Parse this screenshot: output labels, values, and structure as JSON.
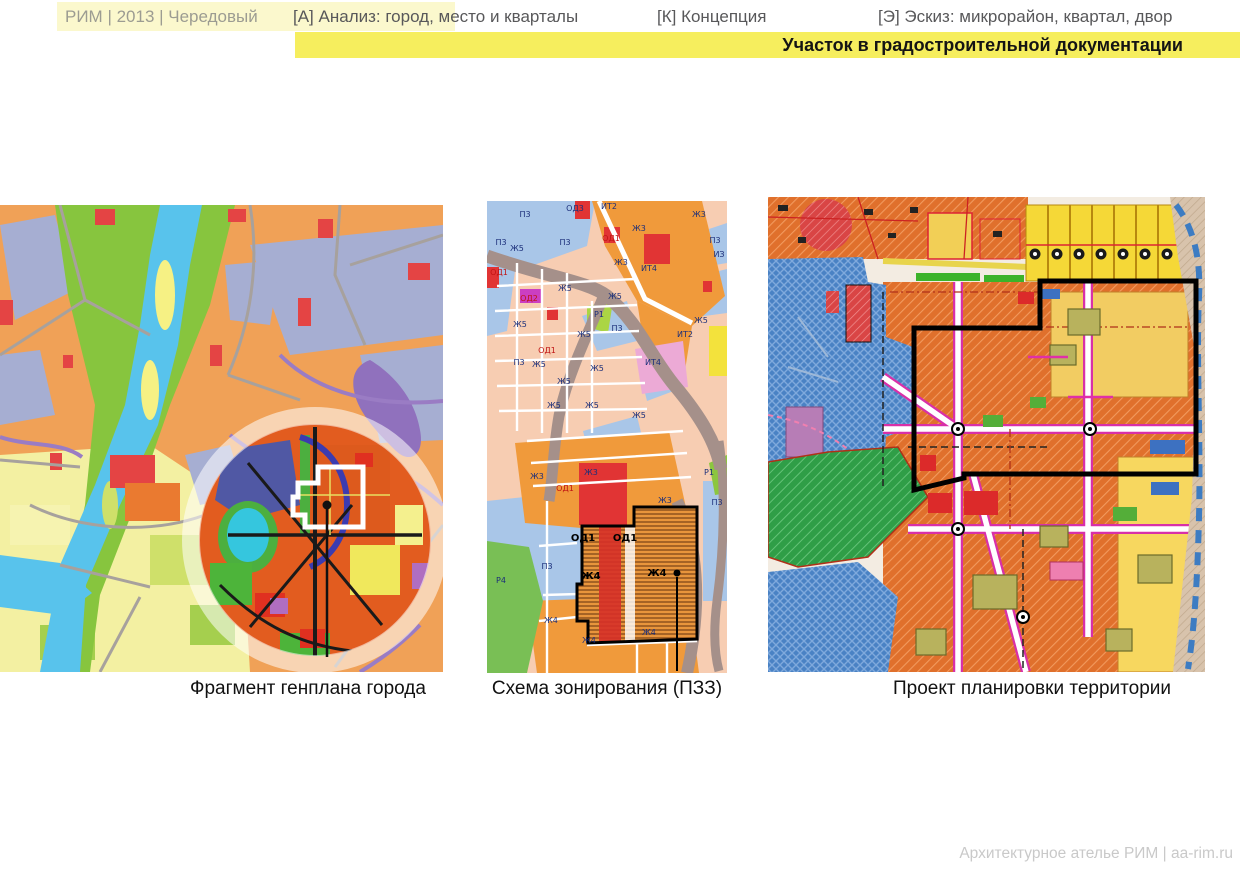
{
  "header": {
    "breadcrumb": "РИМ | 2013 | Чередовый",
    "tabs": [
      {
        "key": "А",
        "label": "[А] Анализ: город, место и кварталы"
      },
      {
        "key": "К",
        "label": "[К] Концепция"
      },
      {
        "key": "Э",
        "label": "[Э] Эскиз: микрорайон, квартал, двор"
      }
    ],
    "subtitle": "Участок в градостроительной документации"
  },
  "figures": [
    {
      "caption": "Фрагмент генплана города"
    },
    {
      "caption": "Схема зонирования (ПЗЗ)"
    },
    {
      "caption": "Проект планировки территории"
    }
  ],
  "zoning": {
    "labels": [
      {
        "text": "П3",
        "x": 38,
        "y": 16
      },
      {
        "text": "ОД3",
        "x": 88,
        "y": 10
      },
      {
        "text": "ИТ2",
        "x": 122,
        "y": 8
      },
      {
        "text": "Ж3",
        "x": 212,
        "y": 16
      },
      {
        "text": "П3",
        "x": 14,
        "y": 44
      },
      {
        "text": "Ж5",
        "x": 30,
        "y": 50
      },
      {
        "text": "П3",
        "x": 78,
        "y": 44
      },
      {
        "text": "ОД1",
        "x": 124,
        "y": 40,
        "cls": "red"
      },
      {
        "text": "Ж3",
        "x": 152,
        "y": 30
      },
      {
        "text": "Ж3",
        "x": 134,
        "y": 64
      },
      {
        "text": "ОД1",
        "x": 12,
        "y": 74,
        "cls": "red"
      },
      {
        "text": "ИЗ",
        "x": 232,
        "y": 56
      },
      {
        "text": "П3",
        "x": 228,
        "y": 42
      },
      {
        "text": "Ж5",
        "x": 78,
        "y": 90
      },
      {
        "text": "ИТ4",
        "x": 162,
        "y": 70
      },
      {
        "text": "Ж5",
        "x": 128,
        "y": 98
      },
      {
        "text": "ОД2",
        "x": 42,
        "y": 100,
        "cls": "red"
      },
      {
        "text": "Р1",
        "x": 112,
        "y": 116
      },
      {
        "text": "Ж5",
        "x": 214,
        "y": 122
      },
      {
        "text": "Ж5",
        "x": 33,
        "y": 126
      },
      {
        "text": "П3",
        "x": 130,
        "y": 130
      },
      {
        "text": "Ж5",
        "x": 97,
        "y": 136
      },
      {
        "text": "ИТ2",
        "x": 198,
        "y": 136
      },
      {
        "text": "ОД1",
        "x": 60,
        "y": 152,
        "cls": "red"
      },
      {
        "text": "П3",
        "x": 32,
        "y": 164
      },
      {
        "text": "Ж5",
        "x": 52,
        "y": 166
      },
      {
        "text": "ИТ4",
        "x": 166,
        "y": 164
      },
      {
        "text": "Ж5",
        "x": 110,
        "y": 170
      },
      {
        "text": "Ж5",
        "x": 77,
        "y": 183
      },
      {
        "text": "Ж5",
        "x": 67,
        "y": 207
      },
      {
        "text": "Ж5",
        "x": 105,
        "y": 207
      },
      {
        "text": "Ж5",
        "x": 152,
        "y": 217
      },
      {
        "text": "Ж3",
        "x": 50,
        "y": 278
      },
      {
        "text": "Ж3",
        "x": 104,
        "y": 274
      },
      {
        "text": "ОД1",
        "x": 78,
        "y": 290,
        "cls": "red"
      },
      {
        "text": "Ж3",
        "x": 178,
        "y": 302
      },
      {
        "text": "Р1",
        "x": 222,
        "y": 274
      },
      {
        "text": "П3",
        "x": 230,
        "y": 304
      },
      {
        "text": "ОД1",
        "x": 96,
        "y": 340,
        "cls": "bold"
      },
      {
        "text": "ОД1",
        "x": 138,
        "y": 340,
        "cls": "bold"
      },
      {
        "text": "П3",
        "x": 60,
        "y": 368
      },
      {
        "text": "Ж4",
        "x": 104,
        "y": 378,
        "cls": "bold"
      },
      {
        "text": "Ж4",
        "x": 170,
        "y": 375,
        "cls": "bold"
      },
      {
        "text": "Р4",
        "x": 14,
        "y": 382
      },
      {
        "text": "Ж4",
        "x": 64,
        "y": 422
      },
      {
        "text": "Ж4",
        "x": 102,
        "y": 442
      },
      {
        "text": "Ж4",
        "x": 162,
        "y": 434
      }
    ]
  },
  "footer": {
    "credit": "Архитектурное ателье РИМ | aa-rim.ru"
  },
  "colors": {
    "highlight": "#f6ee5e",
    "paleHighlight": "#fbf8cd",
    "breadcrumb": "#9c9c92",
    "tabText": "#58585a",
    "subtitleText": "#141414",
    "captionText": "#111111",
    "footerText": "#c9c9c9"
  }
}
